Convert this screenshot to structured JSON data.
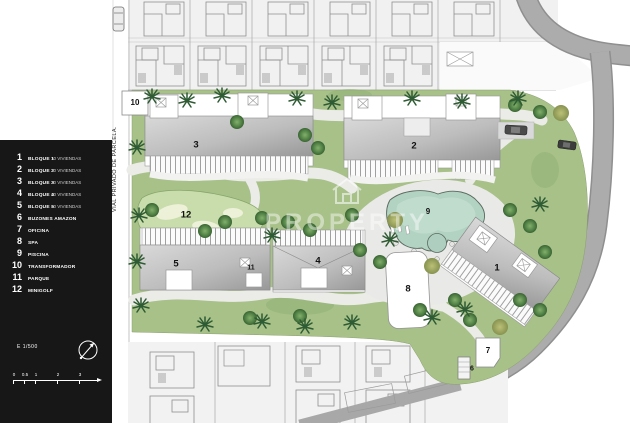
{
  "legend": {
    "items": [
      {
        "num": "1",
        "name": "BLOQUE 1",
        "detail": "10 VIVIENDAS"
      },
      {
        "num": "2",
        "name": "BLOQUE 2",
        "detail": "20 VIVIENDAS"
      },
      {
        "num": "3",
        "name": "BLOQUE 3",
        "detail": "20 VIVIENDAS"
      },
      {
        "num": "4",
        "name": "BLOQUE 4",
        "detail": "10 VIVIENDAS"
      },
      {
        "num": "5",
        "name": "BLOQUE 5",
        "detail": "10 VIVIENDAS"
      },
      {
        "num": "6",
        "name": "BUZONES AMAZON",
        "detail": ""
      },
      {
        "num": "7",
        "name": "OFICINA",
        "detail": ""
      },
      {
        "num": "8",
        "name": "SPA",
        "detail": ""
      },
      {
        "num": "9",
        "name": "PISCINA",
        "detail": ""
      },
      {
        "num": "10",
        "name": "TRANSFORMADOR",
        "detail": ""
      },
      {
        "num": "11",
        "name": "PARQUE",
        "detail": ""
      },
      {
        "num": "12",
        "name": "MINIGOLF",
        "detail": ""
      }
    ],
    "scale_label": "E 1/500",
    "scale_ticks": [
      "0",
      "0.5",
      "1",
      "2",
      "3"
    ]
  },
  "plan": {
    "road_label": "VIAL PRIVADO DE PARCELA.",
    "watermark": "PROPERTY",
    "markers": [
      "1",
      "2",
      "3",
      "4",
      "5",
      "6",
      "7",
      "8",
      "9",
      "10",
      "11",
      "12"
    ]
  },
  "colors": {
    "sidebar_bg": "#171717",
    "green": "#a7c189",
    "road": "#a8a8a8",
    "pool": "#b2d2c2",
    "minigolf": "#c9dcab"
  }
}
